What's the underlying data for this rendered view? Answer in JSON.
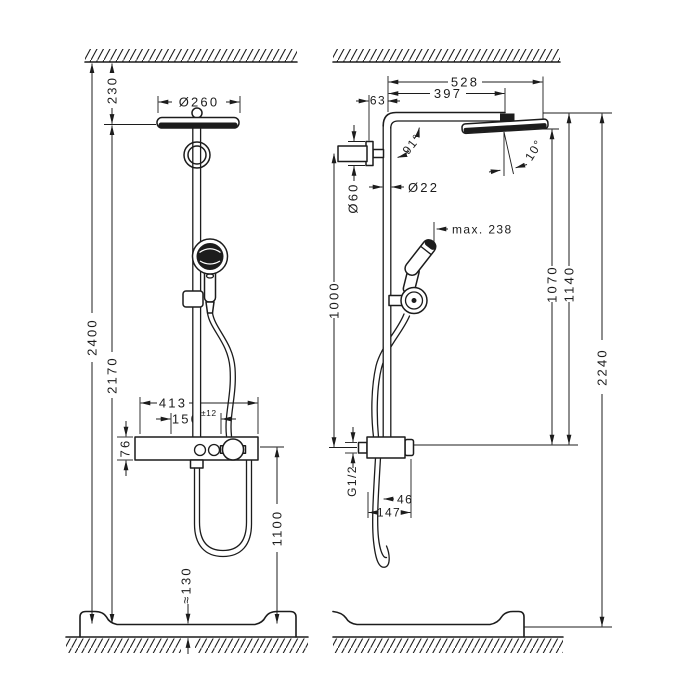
{
  "drawing": {
    "front": {
      "ceiling_to_tub": "2400",
      "ceiling_to_head": "230",
      "head_to_tub": "2170",
      "head_diameter": "Ø260",
      "bar_width": "413",
      "supply_spacing": "150",
      "supply_tolerance": "±12",
      "bar_height": "76",
      "bar_to_tub": "1100",
      "tub_height": "≈130"
    },
    "side": {
      "arm_reach_total": "528",
      "arm_reach_spray": "397",
      "wall_offset": "63",
      "escutcheon_diameter": "Ø60",
      "pipe_diameter": "Ø22",
      "arm_angle": "91°",
      "head_tilt": "10°",
      "handshower_reach": "max. 238",
      "bracket_to_valve": "1000",
      "head_to_valve": "1070",
      "arm_to_valve": "1140",
      "arm_to_tub": "2240",
      "inlet_thread": "G1/2",
      "hose_offset": "46",
      "valve_depth": "147"
    }
  }
}
